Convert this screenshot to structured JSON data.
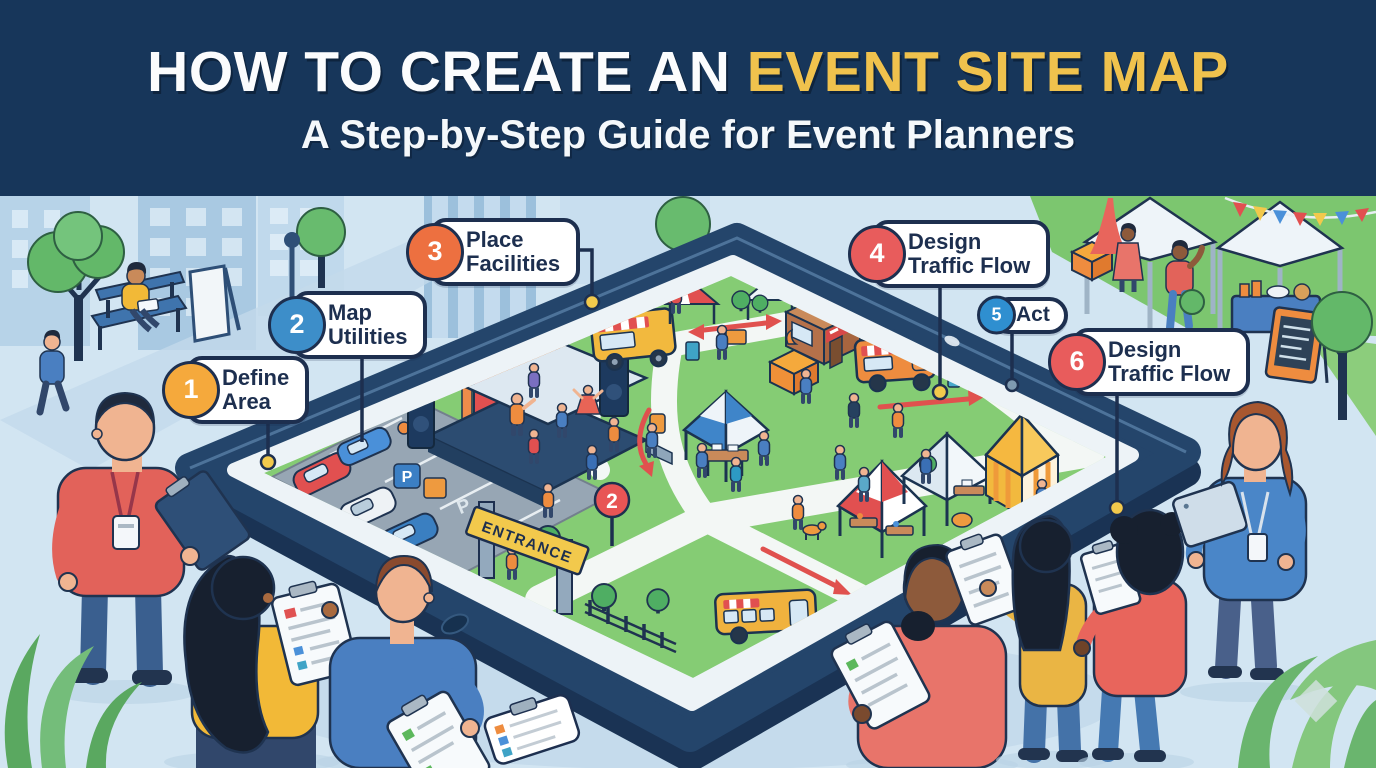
{
  "header": {
    "title_prefix": "HOW TO CREATE AN ",
    "title_highlight": "EVENT SITE MAP",
    "subtitle": "A Step-by-Step Guide for Event Planners"
  },
  "steps": [
    {
      "num": "1",
      "label": "Define\nArea",
      "color": "#f5a93c"
    },
    {
      "num": "2",
      "label": "Map\nUtilities",
      "color": "#3d8ec9"
    },
    {
      "num": "3",
      "label": "Place\nFacilities",
      "color": "#ed7040"
    },
    {
      "num": "4",
      "label": "Design\nTraffic Flow",
      "color": "#e85c5c"
    },
    {
      "num": "5",
      "label": "Act",
      "color": "#2f8fd0"
    },
    {
      "num": "6",
      "label": "Design\nTraffic Flow",
      "color": "#e85c5c"
    }
  ],
  "site_map": {
    "entrance_sign": "ENTRANCE",
    "parking_letter": "P",
    "route_marker": "2"
  },
  "palette": {
    "header_bg": "#17365a",
    "title_highlight": "#f0c24d",
    "scene_bg": "#d2e5f2",
    "tablet_bezel": "#24456b",
    "grass": "#85cc74",
    "path": "#f3f7f5",
    "traffic_arrow": "#e0514e",
    "callout_border": "#1d2f4f"
  }
}
